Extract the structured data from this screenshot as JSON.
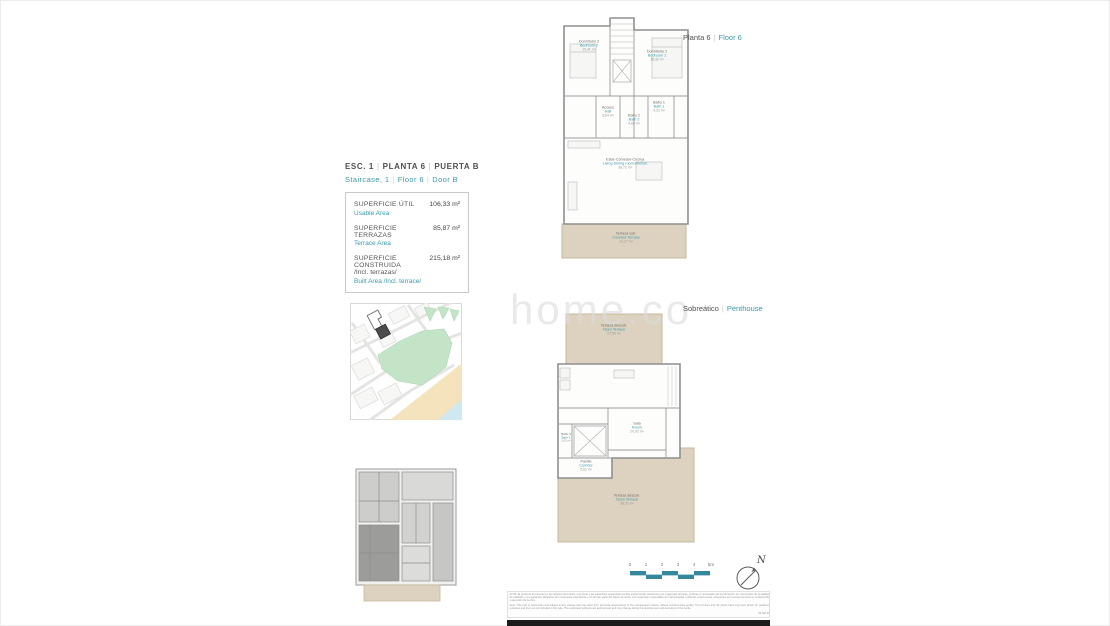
{
  "sep": "|",
  "colors": {
    "accent": "#3a9aab",
    "terrace_fill": "#ddd2bf",
    "scalebar": "#35889c"
  },
  "header": {
    "es": [
      "ESC. 1",
      "PLANTA 6",
      "PUERTA B"
    ],
    "en": [
      "Staircase, 1",
      "Floor 6",
      "Door B"
    ]
  },
  "area_table": {
    "rows": [
      {
        "label_es": "SUPERFICIE ÚTIL",
        "label_en": "Usable Area",
        "value": "106,33 m²"
      },
      {
        "label_es": "SUPERFICIE TERRAZAS",
        "label_en": "Terrace Area",
        "value": "85,87 m²"
      },
      {
        "label_es": "SUPERFICIE CONSTRUIDA",
        "label_es2": "/Incl. terrazas/",
        "label_en": "Built Area /Incl. terrace/",
        "value": "215,18 m²"
      }
    ]
  },
  "watermark": "home.co",
  "upper_plan": {
    "title_es": "Planta 6",
    "title_en": "Floor 6",
    "rooms": {
      "bed2": {
        "es": "Dormitorio 2",
        "en": "Bedroom 2",
        "area": "15,41 m²"
      },
      "bed1": {
        "es": "Dormitorio 1",
        "en": "Bedroom 1",
        "area": "18,30 m²"
      },
      "hall": {
        "es": "Acceso",
        "en": "Hall",
        "area": "6,64 m²"
      },
      "bath1": {
        "es": "Baño 1",
        "en": "Bath 1",
        "area": "4,32 m²"
      },
      "bath2": {
        "es": "Baño 2",
        "en": "Bath 2",
        "area": "4,60 m²"
      },
      "living": {
        "es": "Estar-Comedor-Cocina",
        "en": "Living-Dining room-Kitchen",
        "area": "38,72 m²"
      },
      "terrace": {
        "es": "Terraza cub.",
        "en": "Covered Terrace",
        "area": "19,27 m²"
      }
    }
  },
  "lower_plan": {
    "title_es": "Sobreático",
    "title_en": "Penthouse",
    "rooms": {
      "terrace_top": {
        "es": "Terraza descub.",
        "en": "Open Terrace",
        "area": "27,56 m²"
      },
      "sala": {
        "es": "Sala",
        "en": "Room",
        "area": "20,92 m²"
      },
      "bath3": {
        "es": "Baño 3",
        "en": "Bath 3",
        "area": "3,05 m²"
      },
      "corridor": {
        "es": "Pasillo",
        "en": "Corridor",
        "area": "5,81 m²"
      },
      "terrace_bottom": {
        "es": "Terraza descub.",
        "en": "Open Terrace",
        "area": "38,32 m²"
      }
    }
  },
  "scalebar": {
    "ticks": [
      "0",
      "1",
      "2",
      "3",
      "4",
      "5m"
    ]
  },
  "compass": {
    "label": "N"
  },
  "disclaimer": {
    "es": "NOTA: El presente documento es de carácter informativo. Las obras y las superficies expresadas podrán experimentar variaciones por exigencias técnicas, jurídicas o comerciales de la promoción, sin menoscabo de la calidad. El mobiliario y la vegetación dibujados son meramente orientativos y no forman parte del objeto de venta. Las superficies expresadas son aproximadas, pudiendo experimentar variaciones por razones técnicas en el desarrollo y ejecución de la obra.",
    "en": "Note: This plan is preliminary and subject to any change that may arise from technical requirements or the management criteria, without compromising quality. The furniture and the plants have only been drawn for guidance purposes and they are not included in the sale. The expressed surfaces are approximate and may change during the development and execution of the works.",
    "date": "01.feb.24"
  }
}
